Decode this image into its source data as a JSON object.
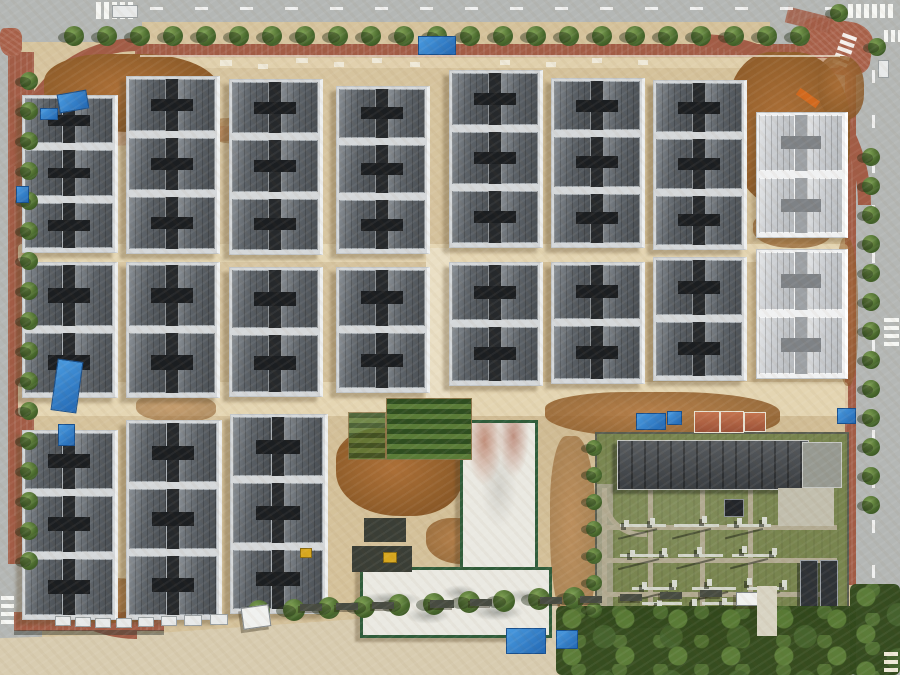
{
  "meta": {
    "description": "Aerial drone photograph of a residential construction site: grid of gray-roofed townhouse blocks on sandy ground, perimeter roads with trees and red-brick sidewalks, construction zones with blue tarps, white concrete buildings with green trim, and an electrical substation with green grounds at bottom right"
  },
  "palette": {
    "sand": "#d5c29b",
    "sand_path": "#e7d9b7",
    "dirt": "#94602c",
    "road": "#b4b7b5",
    "sidewalk_red": "#a25c46",
    "roof_dark": "#5c6268",
    "roof_light": "#c9ccd0",
    "roof_gap": "#26292c",
    "wall_white": "#eef0f0",
    "tree_green": "#4a6a2e",
    "grass": "#78854f",
    "substation_roof": "#44484c",
    "green_trim": "#2f5c3a",
    "tarp_blue": "#2f86d4",
    "white_concrete": "#eae9e2"
  },
  "roads": [
    {
      "cls": "road",
      "x": 0,
      "y": 0,
      "w": 900,
      "h": 22
    },
    {
      "cls": "road",
      "x": 0,
      "y": 0,
      "w": 142,
      "h": 42
    },
    {
      "cls": "road",
      "x": 770,
      "y": 0,
      "w": 130,
      "h": 100
    },
    {
      "cls": "road",
      "x": 852,
      "y": 28,
      "w": 48,
      "h": 647
    },
    {
      "cls": "road",
      "x": 0,
      "y": 0,
      "w": 10,
      "h": 565
    },
    {
      "cls": "road",
      "x": 0,
      "y": 554,
      "w": 42,
      "h": 121
    },
    {
      "cls": "sandroad",
      "x": 0,
      "y": 578,
      "w": 772,
      "h": 97
    }
  ],
  "sidewalks": [
    {
      "cls": "sidewalk",
      "x": 135,
      "y": 44,
      "w": 706,
      "h": 13
    },
    {
      "cls": "sidewalk",
      "x": 8,
      "y": 52,
      "w": 26,
      "h": 512
    },
    {
      "cls": "sidewalk",
      "x": 845,
      "y": 55,
      "w": 11,
      "h": 530
    },
    {
      "cls": "sidewalk",
      "x": 14,
      "y": 612,
      "w": 150,
      "h": 19
    },
    {
      "cls": "plaza",
      "x": 800,
      "y": 20,
      "w": 72,
      "h": 54,
      "r": 8
    },
    {
      "cls": "plaza",
      "x": 0,
      "y": 28,
      "w": 22,
      "h": 28
    },
    {
      "cls": "sidewalk",
      "x": 786,
      "y": 12,
      "w": 46,
      "h": 16,
      "r": 14,
      "o": 0.85
    }
  ],
  "arcs": [
    {
      "corner": "tl",
      "x": 10,
      "y": 38,
      "s": 115
    },
    {
      "corner": "tr",
      "x": 700,
      "y": 34,
      "s": 158
    },
    {
      "corner": "bl",
      "x": 14,
      "y": 516,
      "s": 110
    }
  ],
  "crosswalks": [
    {
      "x": 96,
      "y": 2,
      "n": 5,
      "dx": 8,
      "dy": 0,
      "bw": 5,
      "bh": 17
    },
    {
      "x": 848,
      "y": 4,
      "n": 6,
      "dx": 8,
      "dy": 0,
      "bw": 5,
      "bh": 14
    },
    {
      "x": 836,
      "y": 34,
      "n": 5,
      "dx": 0,
      "dy": 7,
      "bw": 15,
      "bh": 4,
      "r": 20
    },
    {
      "x": 884,
      "y": 30,
      "n": 3,
      "dx": 7,
      "dy": 0,
      "bw": 4,
      "bh": 12
    },
    {
      "x": 884,
      "y": 318,
      "n": 4,
      "dx": 0,
      "dy": 8,
      "bw": 15,
      "bh": 4
    },
    {
      "x": 1,
      "y": 596,
      "n": 4,
      "dx": 0,
      "dy": 8,
      "bw": 13,
      "bh": 4
    }
  ],
  "dashes": [
    {
      "cls": "dashh",
      "x": 150,
      "y": 7,
      "w": 688,
      "h": 3
    },
    {
      "cls": "dashv",
      "x": 872,
      "y": 70,
      "w": 3,
      "h": 580
    }
  ],
  "bands": [
    {
      "cls": "band",
      "x": 18,
      "y": 244,
      "w": 830,
      "h": 18
    },
    {
      "cls": "band",
      "x": 18,
      "y": 382,
      "w": 830,
      "h": 34
    },
    {
      "cls": "whiteband",
      "x": 426,
      "y": 248,
      "w": 24,
      "h": 164
    },
    {
      "cls": "band",
      "x": 140,
      "y": 58,
      "w": 700,
      "h": 10,
      "o": 0.6
    },
    {
      "cls": "pinkpath",
      "x": 44,
      "y": 128,
      "w": 270,
      "h": 15,
      "r": -2.5,
      "o": 0.55
    }
  ],
  "patches": [
    {
      "x": 44,
      "y": 54,
      "w": 175,
      "h": 78
    },
    {
      "x": 728,
      "y": 52,
      "w": 122,
      "h": 158
    },
    {
      "x": 818,
      "y": 56,
      "w": 46,
      "h": 64,
      "o": 0.85
    },
    {
      "x": 336,
      "y": 428,
      "w": 126,
      "h": 88
    },
    {
      "x": 545,
      "y": 392,
      "w": 235,
      "h": 46,
      "o": 0.85
    },
    {
      "x": 550,
      "y": 436,
      "w": 46,
      "h": 195,
      "o": 0.6
    },
    {
      "x": 40,
      "y": 578,
      "w": 130,
      "h": 45,
      "o": 0.75
    },
    {
      "x": 240,
      "y": 565,
      "w": 70,
      "h": 42,
      "o": 0.8
    },
    {
      "x": 136,
      "y": 394,
      "w": 80,
      "h": 28,
      "o": 0.55
    },
    {
      "x": 753,
      "y": 212,
      "w": 78,
      "h": 36,
      "o": 0.7
    },
    {
      "x": 836,
      "y": 238,
      "w": 22,
      "h": 148,
      "o": 0.55
    },
    {
      "x": 426,
      "y": 518,
      "w": 72,
      "h": 46,
      "o": 0.8
    },
    {
      "x": 660,
      "y": 600,
      "w": 100,
      "h": 50,
      "o": 0.85
    },
    {
      "x": 204,
      "y": 118,
      "w": 70,
      "h": 26,
      "o": 0.5
    }
  ],
  "blocks": [
    {
      "x": 22,
      "y": 95,
      "w": 92,
      "h": 156,
      "u": 3
    },
    {
      "x": 126,
      "y": 76,
      "w": 90,
      "h": 176,
      "u": 3
    },
    {
      "x": 229,
      "y": 79,
      "w": 90,
      "h": 174,
      "u": 3
    },
    {
      "x": 336,
      "y": 86,
      "w": 90,
      "h": 166,
      "u": 3
    },
    {
      "x": 449,
      "y": 70,
      "w": 90,
      "h": 176,
      "u": 3
    },
    {
      "x": 551,
      "y": 78,
      "w": 90,
      "h": 168,
      "u": 3
    },
    {
      "x": 653,
      "y": 80,
      "w": 90,
      "h": 168,
      "u": 3
    },
    {
      "x": 756,
      "y": 112,
      "w": 88,
      "h": 124,
      "u": 2,
      "v": "light"
    },
    {
      "x": 22,
      "y": 262,
      "w": 92,
      "h": 134,
      "u": 2
    },
    {
      "x": 126,
      "y": 262,
      "w": 90,
      "h": 134,
      "u": 2
    },
    {
      "x": 229,
      "y": 267,
      "w": 90,
      "h": 128,
      "u": 2
    },
    {
      "x": 336,
      "y": 267,
      "w": 90,
      "h": 124,
      "u": 2
    },
    {
      "x": 449,
      "y": 262,
      "w": 90,
      "h": 122,
      "u": 2
    },
    {
      "x": 551,
      "y": 262,
      "w": 90,
      "h": 120,
      "u": 2
    },
    {
      "x": 653,
      "y": 257,
      "w": 90,
      "h": 122,
      "u": 2
    },
    {
      "x": 756,
      "y": 249,
      "w": 88,
      "h": 128,
      "u": 2,
      "v": "light"
    },
    {
      "x": 22,
      "y": 430,
      "w": 92,
      "h": 188,
      "u": 3
    },
    {
      "x": 126,
      "y": 420,
      "w": 92,
      "h": 198,
      "u": 3
    },
    {
      "x": 230,
      "y": 414,
      "w": 94,
      "h": 198,
      "u": 3
    }
  ],
  "white_buildings": [
    {
      "x": 460,
      "y": 420,
      "w": 72,
      "h": 146,
      "stain": "R"
    },
    {
      "x": 360,
      "y": 567,
      "w": 186,
      "h": 65,
      "stain": "G"
    }
  ],
  "substation": {
    "x": 595,
    "y": 432,
    "w": 250,
    "h": 192,
    "building": {
      "x": 20,
      "y": 6,
      "w": 190,
      "h": 48
    },
    "wing": {
      "x": 205,
      "y": 8,
      "w": 38,
      "h": 44
    },
    "pad": {
      "x": 181,
      "y": 54,
      "w": 56,
      "h": 38
    },
    "strip": {
      "x": 0,
      "y": 50,
      "w": 16,
      "h": 124
    },
    "curve": {
      "x": 5,
      "y": 58,
      "w": 40,
      "h": 40
    },
    "paths": [
      {
        "x": 5,
        "y": 54,
        "w": 5,
        "h": 132
      },
      {
        "x": 51,
        "y": 54,
        "w": 5,
        "h": 132
      },
      {
        "x": 103,
        "y": 54,
        "w": 5,
        "h": 132
      },
      {
        "x": 151,
        "y": 54,
        "w": 5,
        "h": 132
      },
      {
        "x": 5,
        "y": 91,
        "w": 235,
        "h": 5
      },
      {
        "x": 5,
        "y": 124,
        "w": 235,
        "h": 5
      },
      {
        "x": 5,
        "y": 158,
        "w": 235,
        "h": 5
      }
    ],
    "gantries": [
      {
        "x": 23,
        "y": 90,
        "w": 46
      },
      {
        "x": 77,
        "y": 90,
        "w": 45
      },
      {
        "x": 130,
        "y": 90,
        "w": 44
      },
      {
        "x": 23,
        "y": 120,
        "w": 48
      },
      {
        "x": 81,
        "y": 120,
        "w": 45
      },
      {
        "x": 135,
        "y": 120,
        "w": 44
      },
      {
        "x": 35,
        "y": 153,
        "w": 44
      },
      {
        "x": 95,
        "y": 153,
        "w": 44
      },
      {
        "x": 150,
        "y": 153,
        "w": 40
      },
      {
        "x": 45,
        "y": 168,
        "w": 40
      },
      {
        "x": 105,
        "y": 168,
        "w": 42
      }
    ],
    "dots": [
      {
        "x": 27,
        "y": 86
      },
      {
        "x": 53,
        "y": 84
      },
      {
        "x": 105,
        "y": 82
      },
      {
        "x": 140,
        "y": 84
      },
      {
        "x": 165,
        "y": 83
      },
      {
        "x": 33,
        "y": 116
      },
      {
        "x": 65,
        "y": 114
      },
      {
        "x": 100,
        "y": 113
      },
      {
        "x": 145,
        "y": 112
      },
      {
        "x": 175,
        "y": 114
      },
      {
        "x": 45,
        "y": 148
      },
      {
        "x": 75,
        "y": 146
      },
      {
        "x": 110,
        "y": 145
      },
      {
        "x": 150,
        "y": 144
      },
      {
        "x": 185,
        "y": 146
      },
      {
        "x": 60,
        "y": 166
      },
      {
        "x": 95,
        "y": 165
      },
      {
        "x": 125,
        "y": 164
      }
    ],
    "transformers": [
      {
        "x": 203,
        "y": 126,
        "w": 16,
        "h": 46
      },
      {
        "x": 223,
        "y": 126,
        "w": 16,
        "h": 46
      }
    ],
    "box": {
      "x": 127,
      "y": 65,
      "w": 18,
      "h": 16
    },
    "wall": {
      "x": 0,
      "y": 174,
      "w": 250,
      "h": 12
    }
  },
  "tree_rows": [
    {
      "x": 64,
      "y": 26,
      "dx": 33,
      "dy": 0,
      "n": 23,
      "r": 10
    },
    {
      "x": 20,
      "y": 72,
      "dx": 0,
      "dy": 30,
      "n": 17,
      "r": 9
    },
    {
      "x": 862,
      "y": 148,
      "dx": 0,
      "dy": 29,
      "n": 13,
      "r": 9
    },
    {
      "x": 248,
      "y": 600,
      "dx": 35,
      "dy": -1.5,
      "n": 10,
      "r": 11
    },
    {
      "x": 586,
      "y": 440,
      "dx": 0,
      "dy": 27,
      "n": 7,
      "r": 8
    },
    {
      "x": 830,
      "y": 4,
      "dx": 38,
      "dy": 34,
      "n": 2,
      "r": 9
    }
  ],
  "tree_bands": [
    {
      "x": 556,
      "y": 606,
      "w": 300,
      "h": 69
    },
    {
      "x": 850,
      "y": 584,
      "w": 50,
      "h": 91
    }
  ],
  "props": [
    {
      "t": "tarp",
      "x": 418,
      "y": 36,
      "w": 36,
      "h": 17
    },
    {
      "t": "tarp",
      "x": 636,
      "y": 413,
      "w": 28,
      "h": 15
    },
    {
      "t": "tarp",
      "x": 667,
      "y": 411,
      "w": 13,
      "h": 12
    },
    {
      "t": "tarp",
      "x": 54,
      "y": 360,
      "w": 24,
      "h": 50,
      "r": 8
    },
    {
      "t": "tarp",
      "x": 58,
      "y": 424,
      "w": 15,
      "h": 20
    },
    {
      "t": "tarp",
      "x": 16,
      "y": 186,
      "w": 11,
      "h": 15
    },
    {
      "t": "tarp",
      "x": 58,
      "y": 92,
      "w": 28,
      "h": 17,
      "r": -10
    },
    {
      "t": "tarp",
      "x": 40,
      "y": 108,
      "w": 16,
      "h": 10
    },
    {
      "t": "tarp",
      "x": 506,
      "y": 628,
      "w": 38,
      "h": 24
    },
    {
      "t": "tarp",
      "x": 556,
      "y": 630,
      "w": 20,
      "h": 17
    },
    {
      "t": "tarp",
      "x": 837,
      "y": 408,
      "w": 17,
      "h": 14
    },
    {
      "t": "shed",
      "x": 694,
      "y": 411,
      "w": 24,
      "h": 20
    },
    {
      "t": "shed",
      "x": 720,
      "y": 411,
      "w": 22,
      "h": 20
    },
    {
      "t": "shed",
      "x": 744,
      "y": 412,
      "w": 20,
      "h": 18
    },
    {
      "t": "dark",
      "x": 352,
      "y": 546,
      "w": 60,
      "h": 26
    },
    {
      "t": "dark",
      "x": 364,
      "y": 518,
      "w": 42,
      "h": 24
    },
    {
      "t": "dark",
      "x": 14,
      "y": 630,
      "w": 150,
      "h": 5,
      "o": 0.5
    },
    {
      "t": "garden",
      "x": 386,
      "y": 398,
      "w": 84,
      "h": 60
    },
    {
      "t": "garden",
      "x": 348,
      "y": 412,
      "w": 36,
      "h": 46,
      "o": 0.8
    },
    {
      "t": "crane",
      "x": 796,
      "y": 94,
      "w": 24,
      "h": 8,
      "r": 35
    },
    {
      "t": "mach",
      "x": 383,
      "y": 552,
      "w": 12,
      "h": 9
    },
    {
      "t": "mach",
      "x": 300,
      "y": 548,
      "w": 10,
      "h": 8
    },
    {
      "t": "car",
      "x": 112,
      "y": 5,
      "w": 24,
      "h": 11
    },
    {
      "t": "car",
      "x": 878,
      "y": 60,
      "w": 9,
      "h": 16
    },
    {
      "t": "car",
      "x": 55,
      "y": 616,
      "w": 14,
      "h": 8
    },
    {
      "t": "car",
      "x": 75,
      "y": 617,
      "w": 14,
      "h": 8
    },
    {
      "t": "car",
      "x": 95,
      "y": 618,
      "w": 14,
      "h": 8
    },
    {
      "t": "car",
      "x": 116,
      "y": 618,
      "w": 14,
      "h": 8
    },
    {
      "t": "car",
      "x": 138,
      "y": 617,
      "w": 14,
      "h": 8
    },
    {
      "t": "car",
      "x": 161,
      "y": 616,
      "w": 14,
      "h": 8
    },
    {
      "t": "car",
      "x": 184,
      "y": 615,
      "w": 16,
      "h": 9
    },
    {
      "t": "car",
      "x": 210,
      "y": 614,
      "w": 16,
      "h": 9
    },
    {
      "t": "truck",
      "x": 242,
      "y": 606,
      "w": 26,
      "h": 20,
      "r": -8
    },
    {
      "t": "truck",
      "x": 736,
      "y": 592,
      "w": 20,
      "h": 12
    },
    {
      "t": "mat",
      "x": 300,
      "y": 604,
      "w": 22,
      "h": 7
    },
    {
      "t": "mat",
      "x": 336,
      "y": 603,
      "w": 22,
      "h": 7
    },
    {
      "t": "mat",
      "x": 372,
      "y": 602,
      "w": 22,
      "h": 7
    },
    {
      "t": "mat",
      "x": 430,
      "y": 600,
      "w": 24,
      "h": 8
    },
    {
      "t": "mat",
      "x": 470,
      "y": 599,
      "w": 22,
      "h": 7
    },
    {
      "t": "mat",
      "x": 540,
      "y": 597,
      "w": 22,
      "h": 7
    },
    {
      "t": "mat",
      "x": 580,
      "y": 596,
      "w": 22,
      "h": 7
    },
    {
      "t": "mat",
      "x": 620,
      "y": 594,
      "w": 22,
      "h": 7
    },
    {
      "t": "mat",
      "x": 660,
      "y": 592,
      "w": 22,
      "h": 7
    },
    {
      "t": "mat",
      "x": 700,
      "y": 590,
      "w": 22,
      "h": 7
    },
    {
      "t": "wm",
      "x": 220,
      "y": 60,
      "w": 12,
      "h": 6
    },
    {
      "t": "wm",
      "x": 258,
      "y": 64,
      "w": 10,
      "h": 5
    },
    {
      "t": "wm",
      "x": 296,
      "y": 58,
      "w": 12,
      "h": 5
    },
    {
      "t": "wm",
      "x": 334,
      "y": 62,
      "w": 10,
      "h": 5
    },
    {
      "t": "wm",
      "x": 372,
      "y": 58,
      "w": 10,
      "h": 5
    },
    {
      "t": "wm",
      "x": 410,
      "y": 62,
      "w": 10,
      "h": 5
    },
    {
      "t": "wm",
      "x": 500,
      "y": 60,
      "w": 10,
      "h": 5
    },
    {
      "t": "wm",
      "x": 546,
      "y": 62,
      "w": 10,
      "h": 5
    },
    {
      "t": "wm",
      "x": 592,
      "y": 58,
      "w": 10,
      "h": 5
    },
    {
      "t": "wm",
      "x": 638,
      "y": 60,
      "w": 10,
      "h": 5
    },
    {
      "t": "wm",
      "x": 140,
      "y": 55,
      "w": 700,
      "h": 2,
      "o": 0.7
    },
    {
      "t": "wm",
      "x": 884,
      "y": 652,
      "w": 14,
      "h": 4
    },
    {
      "t": "wm",
      "x": 884,
      "y": 660,
      "w": 14,
      "h": 4
    },
    {
      "t": "wm",
      "x": 884,
      "y": 668,
      "w": 14,
      "h": 4
    },
    {
      "t": "conc",
      "x": 757,
      "y": 586,
      "w": 20,
      "h": 50
    }
  ]
}
